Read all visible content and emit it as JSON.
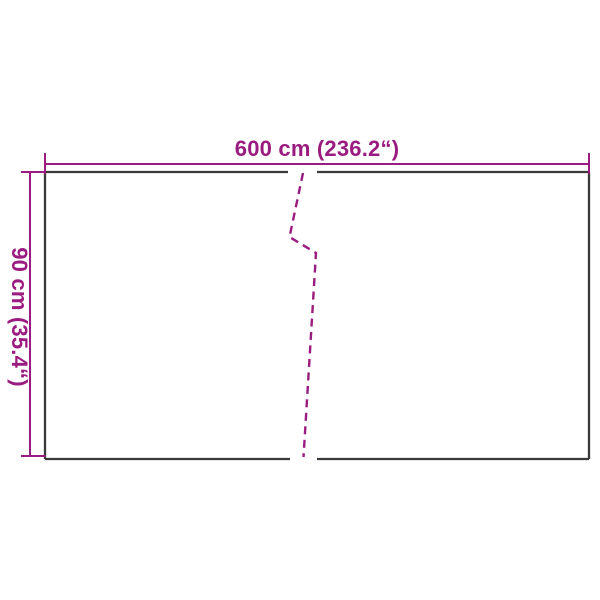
{
  "diagram": {
    "dimensions": {
      "width_label": "600 cm (236.2“)",
      "height_label": "90 cm (35.4“)"
    },
    "colors": {
      "dimension_magenta": "#9A1C80",
      "outline_dark": "#3A393B",
      "background": "#FFFFFF"
    }
  }
}
